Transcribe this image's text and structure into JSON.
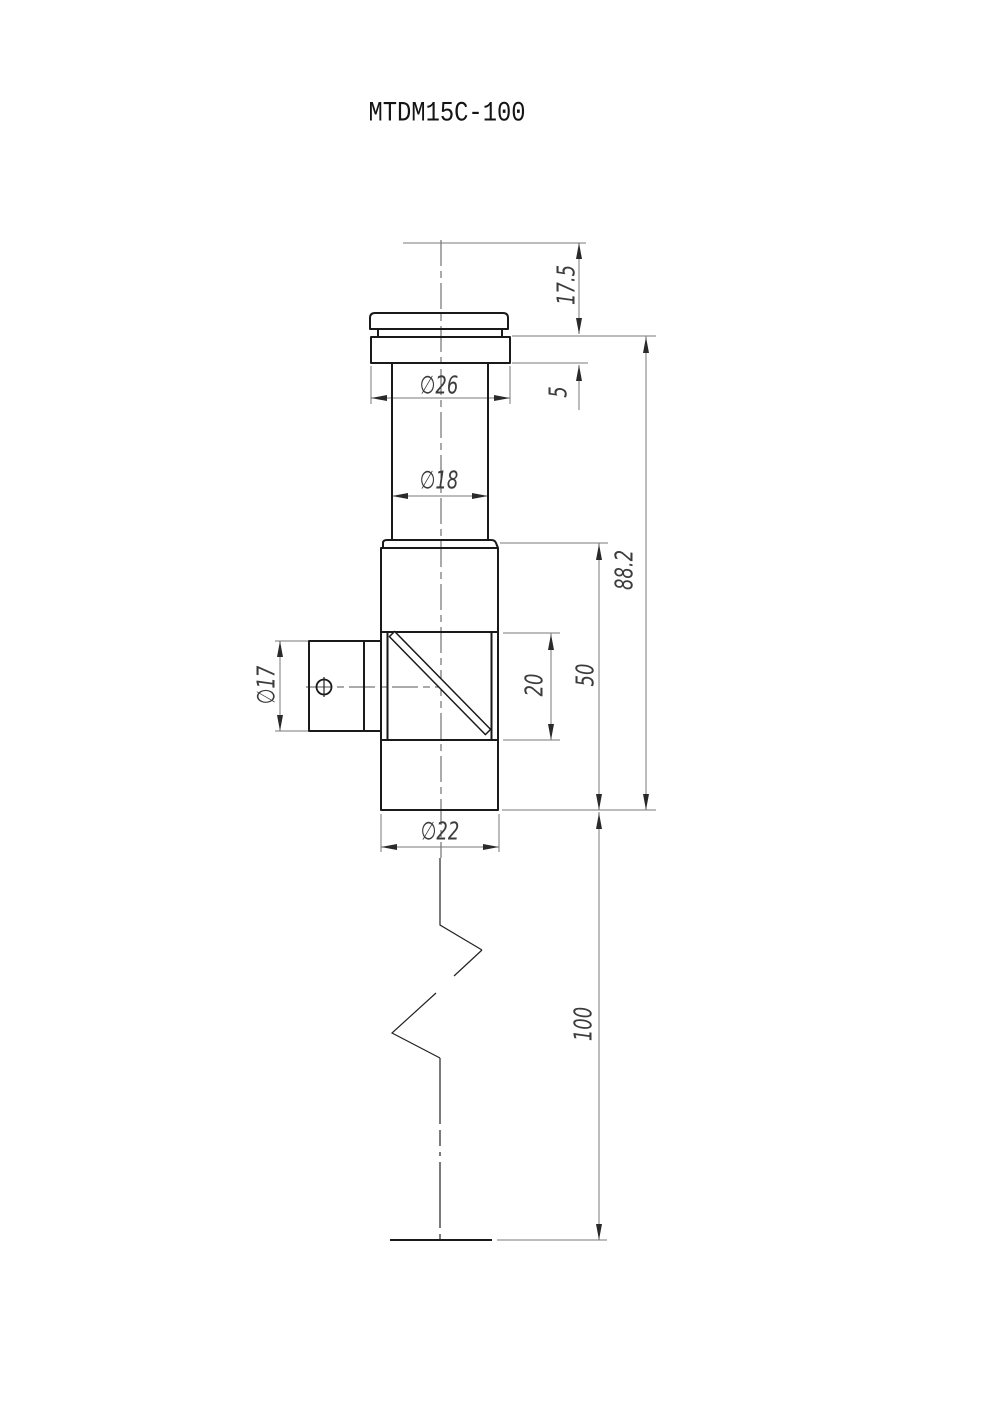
{
  "title": "MTDM15C-100",
  "drawing": {
    "dims": {
      "top_offset": "17.5",
      "flange_thickness": "5",
      "flange_diameter": "∅26",
      "tube_diameter": "∅18",
      "overall_body_length": "88.2",
      "body_section_length": "50",
      "window_height": "20",
      "side_port_diameter": "∅17",
      "body_diameter": "∅22",
      "rod_length": "100"
    }
  },
  "colors": {
    "background": "#ffffff",
    "object_line": "#1a1a1a",
    "dimension_line": "#787878",
    "text": "#3c3c3c"
  }
}
